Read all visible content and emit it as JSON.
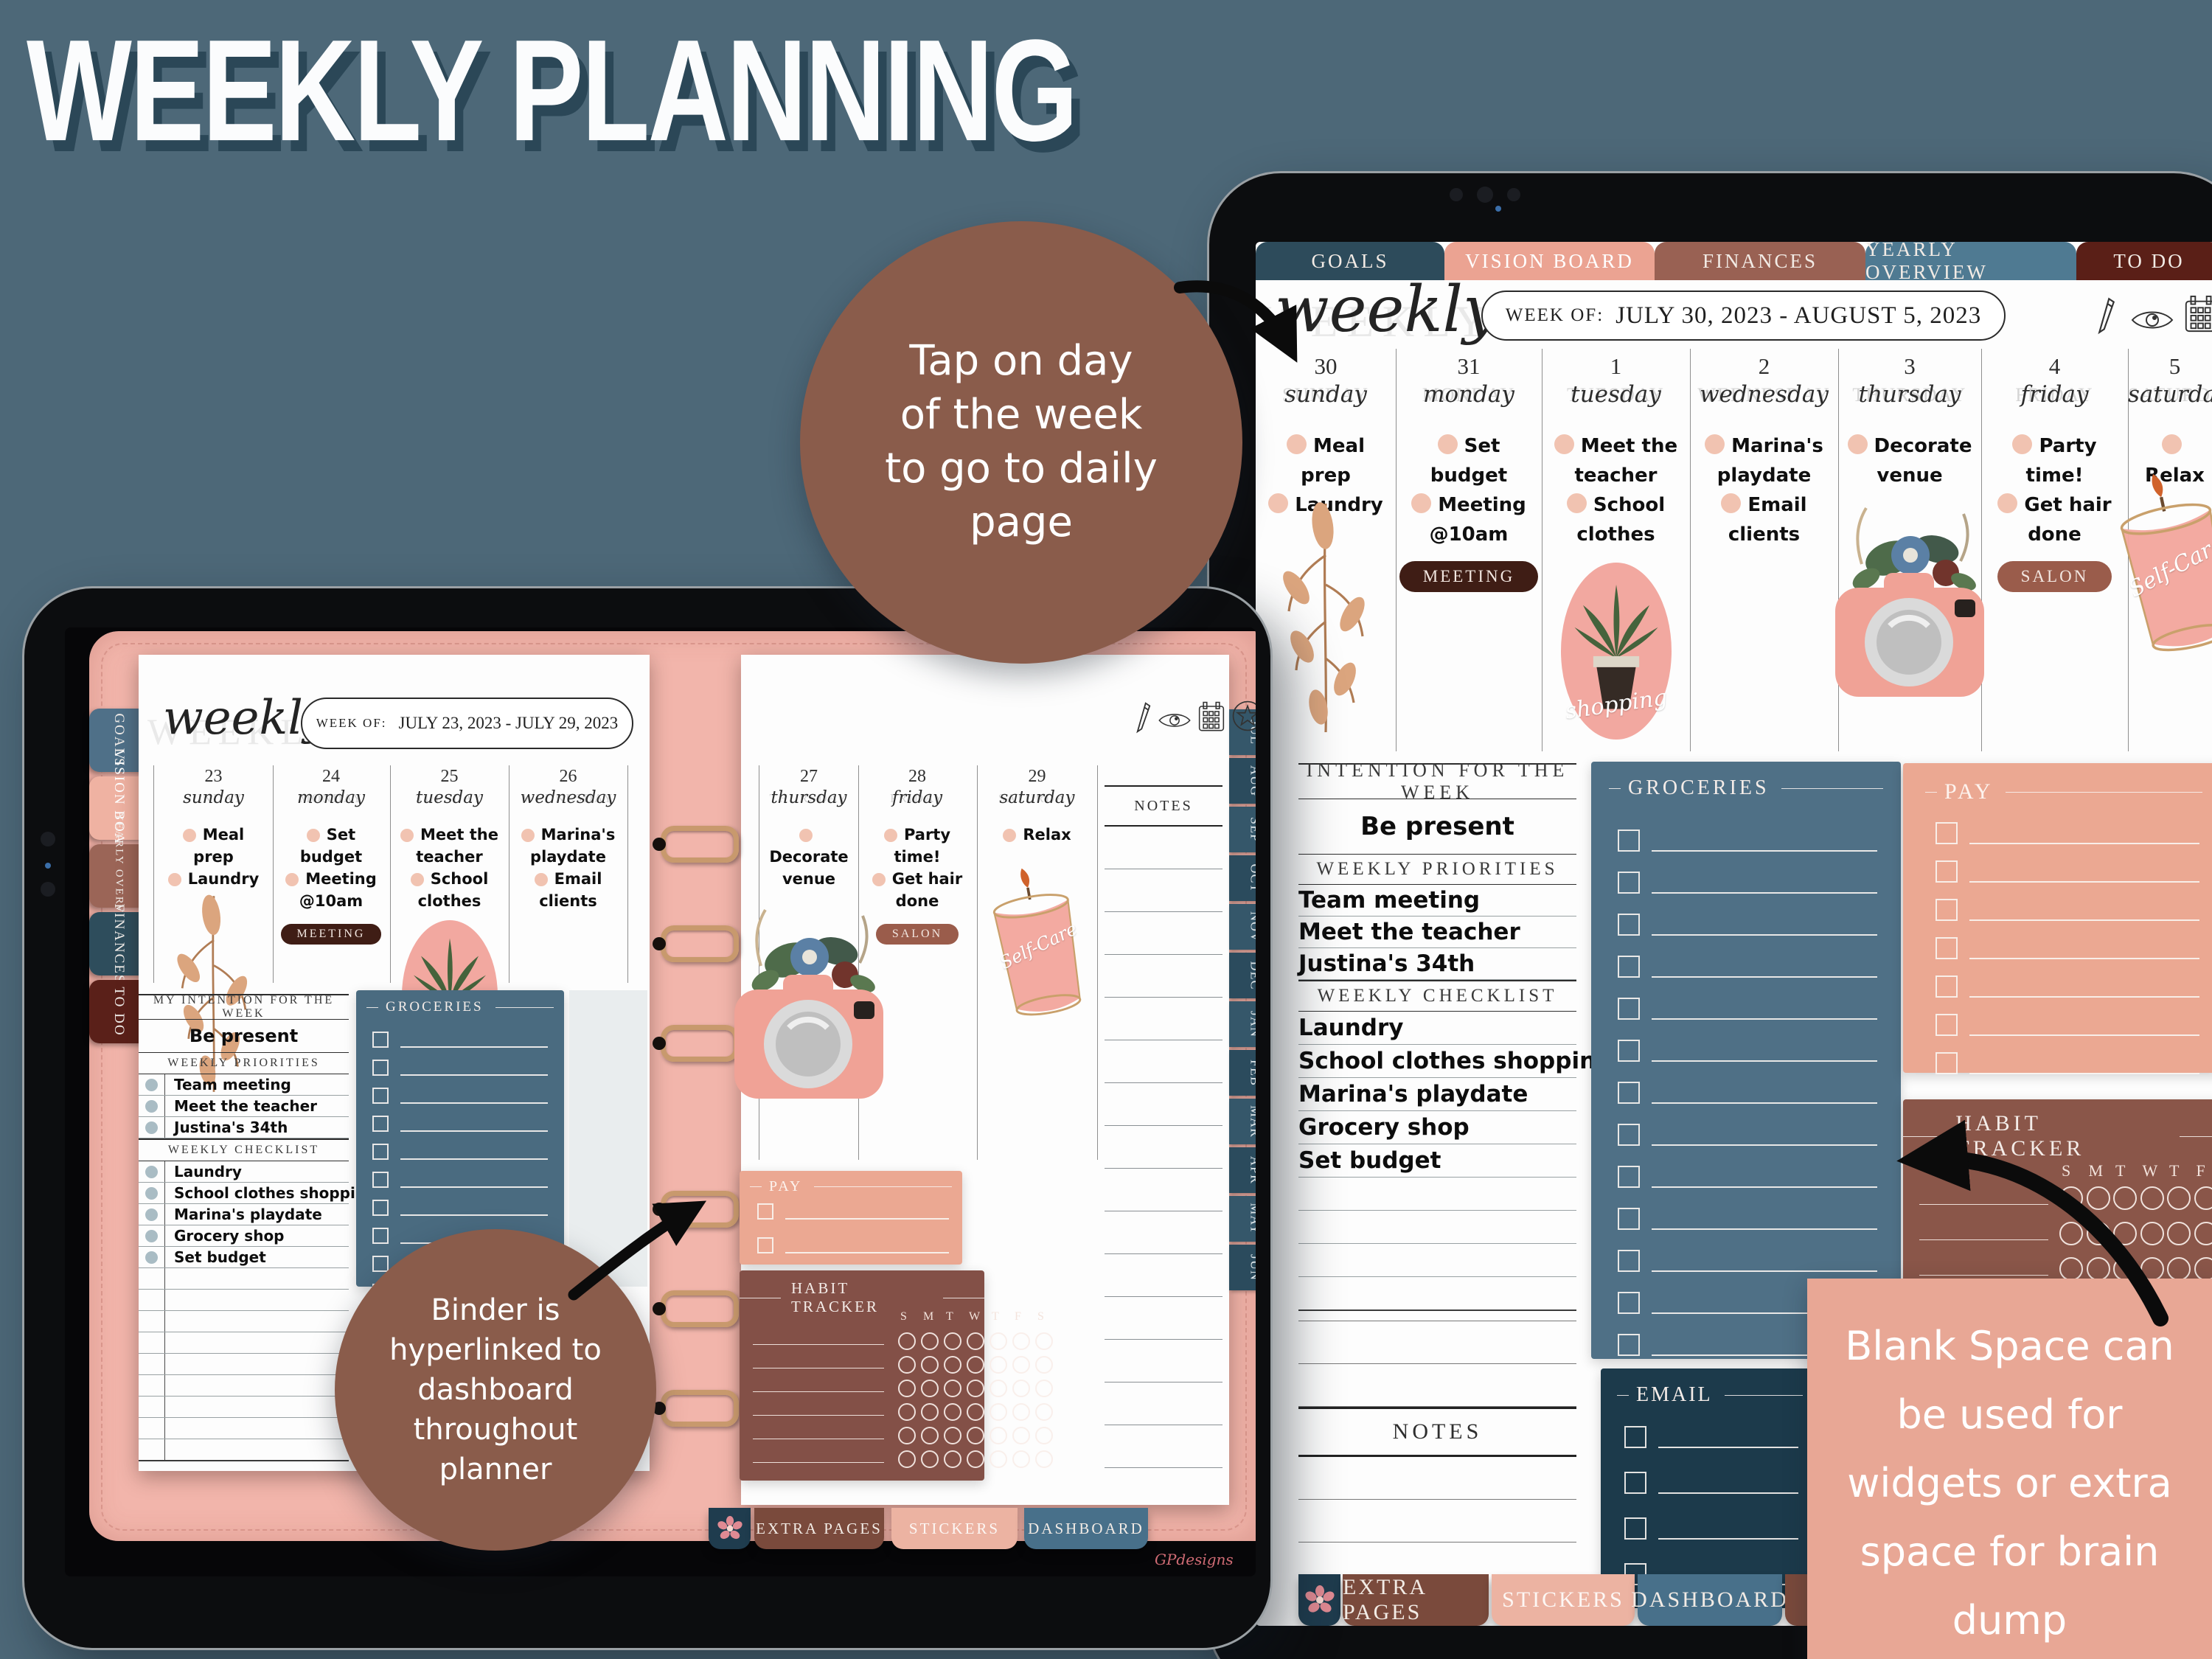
{
  "page_title": "WEEKLY PLANNING",
  "colors": {
    "background": "#4d6878",
    "annotation_circle": "#8a5c4b",
    "annotation_box": "#e8a795",
    "tab_goals": "#2d4b5b",
    "tab_vision_board": "#eba392",
    "tab_finances": "#996153",
    "tab_yearly_overview": "#4f7a92",
    "tab_to_do": "#5a1f17",
    "panel_groceries": "#4f7086",
    "panel_pay": "#eba892",
    "panel_habit_tracker": "#8a5649",
    "panel_email": "#1c3a4b",
    "binder_leather": "#f2b5ab",
    "task_dot": "#f1c3b1",
    "badge_meeting": "#3f1d15",
    "badge_salon": "#9a5c4b"
  },
  "annotations": {
    "tap_circle_lines": [
      "Tap on day",
      "of the week",
      "to go to daily",
      "page"
    ],
    "binder_circle_lines": [
      "Binder is",
      "hyperlinked to",
      "dashboard",
      "throughout",
      "planner"
    ],
    "blank_box_lines": [
      "Blank Space can",
      "be used for",
      "widgets or extra",
      "space for brain",
      "dump"
    ]
  },
  "planner": {
    "nav_tabs": [
      "GOALS",
      "VISION BOARD",
      "FINANCES",
      "YEARLY OVERVIEW",
      "TO DO"
    ],
    "side_tabs": [
      "GOALS",
      "VISION BOARD",
      "YEARLY OVERVIEW",
      "FINANCES",
      "TO DO"
    ],
    "month_tabs": [
      "JUL",
      "AUG",
      "SEP",
      "OCT",
      "NOV",
      "DEC",
      "JAN",
      "FEB",
      "MAR",
      "APR",
      "MAY",
      "JUN"
    ],
    "bottom_tabs": [
      "EXTRA PAGES",
      "STICKERS",
      "DASHBOARD"
    ]
  },
  "right_tablet": {
    "header": {
      "ghost": "WEEKLY",
      "script": "weekly",
      "week_of_label": "WEEK OF:",
      "week_of_value": "JULY 30, 2023 - AUGUST 5, 2023"
    },
    "toolbar_icons": [
      "pencil-icon",
      "eye-icon",
      "calendar-icon"
    ],
    "days": [
      {
        "num": "30",
        "ghost": "SUNDAY",
        "name": "sunday",
        "tasks": [
          "Meal prep",
          "Laundry"
        ]
      },
      {
        "num": "31",
        "ghost": "MONDAY",
        "name": "monday",
        "tasks": [
          "Set budget",
          "Meeting @10am"
        ],
        "badge": "MEETING"
      },
      {
        "num": "1",
        "ghost": "TUESDAY",
        "name": "tuesday",
        "tasks": [
          "Meet the teacher",
          "School clothes"
        ],
        "sticker_label": "shopping"
      },
      {
        "num": "2",
        "ghost": "WEDNESDAY",
        "name": "wednesday",
        "tasks": [
          "Marina's playdate",
          "Email clients"
        ]
      },
      {
        "num": "3",
        "ghost": "THURSDAY",
        "name": "thursday",
        "tasks": [
          "Decorate venue"
        ]
      },
      {
        "num": "4",
        "ghost": "FRIDAY",
        "name": "friday",
        "tasks": [
          "Party time!",
          "Get hair done"
        ],
        "badge": "SALON"
      },
      {
        "num": "5",
        "ghost": "SATURDAY",
        "name": "saturday",
        "tasks": [
          "Relax"
        ],
        "sticker_label": "Self-Care"
      }
    ],
    "intention_header": "INTENTION FOR THE WEEK",
    "intention_value": "Be present",
    "priorities_header": "WEEKLY PRIORITIES",
    "priorities": [
      "Team meeting",
      "Meet the teacher",
      "Justina's 34th"
    ],
    "checklist_header": "WEEKLY CHECKLIST",
    "checklist": [
      "Laundry",
      "School clothes shopping",
      "Marina's playdate",
      "Grocery shop",
      "Set budget"
    ],
    "groceries_title": "GROCERIES",
    "pay_title": "PAY",
    "habit_title": "HABIT TRACKER",
    "habit_days": [
      "S",
      "M",
      "T",
      "W",
      "T",
      "F",
      "S"
    ],
    "email_title": "EMAIL",
    "notes_title": "NOTES"
  },
  "left_tablet": {
    "header": {
      "ghost": "WEEKLY",
      "script": "weekly",
      "week_of_label": "WEEK OF:",
      "week_of_value": "JULY 23, 2023 - JULY 29, 2023"
    },
    "toolbar_icons": [
      "pencil-icon",
      "eye-icon",
      "calendar-icon",
      "star-icon"
    ],
    "days": [
      {
        "num": "23",
        "ghost": "SUNDAY",
        "name": "sunday",
        "tasks": [
          "Meal prep",
          "Laundry"
        ]
      },
      {
        "num": "24",
        "ghost": "MONDAY",
        "name": "monday",
        "tasks": [
          "Set budget",
          "Meeting @10am"
        ],
        "badge": "MEETING"
      },
      {
        "num": "25",
        "ghost": "TUESDAY",
        "name": "tuesday",
        "tasks": [
          "Meet the teacher",
          "School clothes"
        ],
        "sticker_label": "shopping"
      },
      {
        "num": "26",
        "ghost": "WEDNESDAY",
        "name": "wednesday",
        "tasks": [
          "Marina's playdate",
          "Email clients"
        ]
      },
      {
        "num": "27",
        "ghost": "THURSDAY",
        "name": "thursday",
        "tasks": [
          "Decorate venue"
        ]
      },
      {
        "num": "28",
        "ghost": "FRIDAY",
        "name": "friday",
        "tasks": [
          "Party time!",
          "Get hair done"
        ],
        "badge": "SALON"
      },
      {
        "num": "29",
        "ghost": "SATURDAY",
        "name": "saturday",
        "tasks": [
          "Relax"
        ],
        "sticker_label": "Self-Care"
      }
    ],
    "intention_header": "MY INTENTION FOR THE WEEK",
    "intention_value": "Be present",
    "priorities_header": "WEEKLY PRIORITIES",
    "priorities": [
      "Team meeting",
      "Meet the teacher",
      "Justina's 34th"
    ],
    "checklist_header": "WEEKLY CHECKLIST",
    "checklist": [
      "Laundry",
      "School clothes shopping",
      "Marina's playdate",
      "Grocery shop",
      "Set budget"
    ],
    "groceries_title": "GROCERIES",
    "pay_title": "PAY",
    "habit_title": "HABIT TRACKER",
    "habit_days": [
      "S",
      "M",
      "T",
      "W",
      "T",
      "F",
      "S"
    ],
    "notes_title": "NOTES",
    "watermark": "GPdesigns"
  }
}
